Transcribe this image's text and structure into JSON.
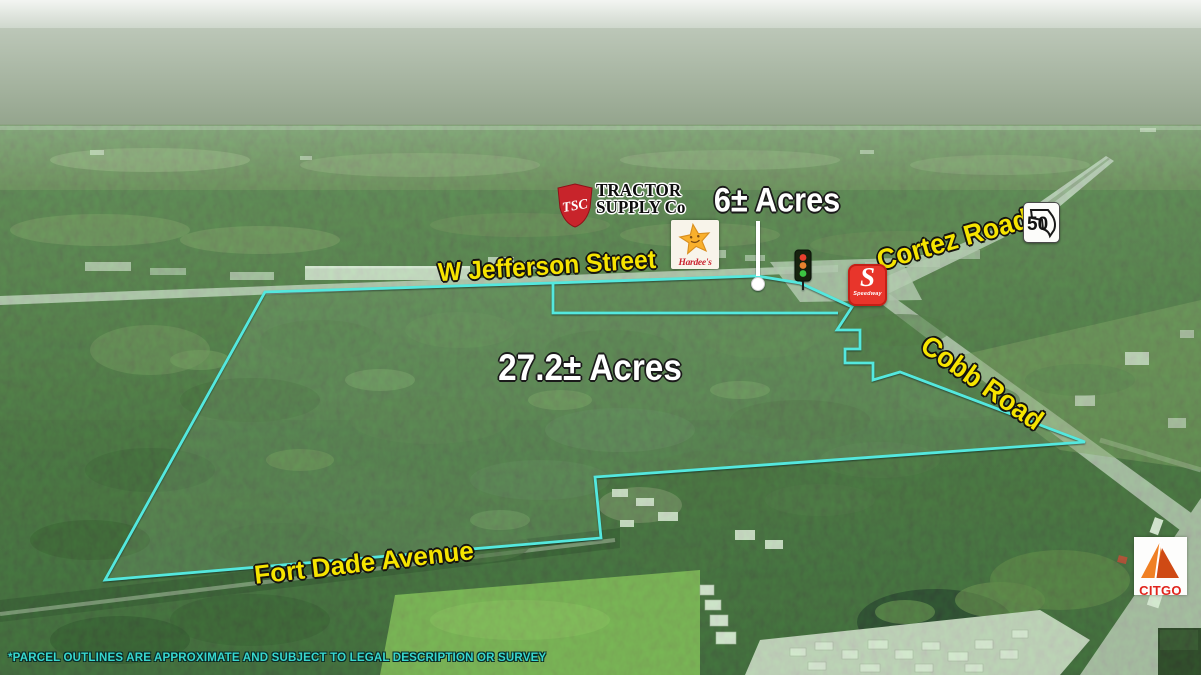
{
  "annotations": {
    "parcel_large_label": "27.2± Acres",
    "parcel_small_label": "6± Acres",
    "roads": {
      "w_jefferson": "W Jefferson Street",
      "cortez": "Cortez Road",
      "cobb": "Cobb Road",
      "fort_dade": "Fort Dade Avenue"
    },
    "route_shield": "50",
    "disclaimer": "*PARCEL OUTLINES ARE APPROXIMATE AND SUBJECT TO LEGAL DESCRIPTION OR SURVEY"
  },
  "logos": {
    "tractor_supply": {
      "shield": "TSC",
      "line1": "TRACTOR",
      "line2": "SUPPLY Co"
    },
    "hardees": {
      "name": "Hardee's"
    },
    "speedway": {
      "initial": "S",
      "name": "Speedway"
    },
    "citgo": {
      "name": "CITGO"
    }
  },
  "colors": {
    "parcel_outline": "#54e8de",
    "road_label": "#f6e400",
    "acre_label": "#ffffff",
    "disclaimer_text": "#38d8cf"
  }
}
